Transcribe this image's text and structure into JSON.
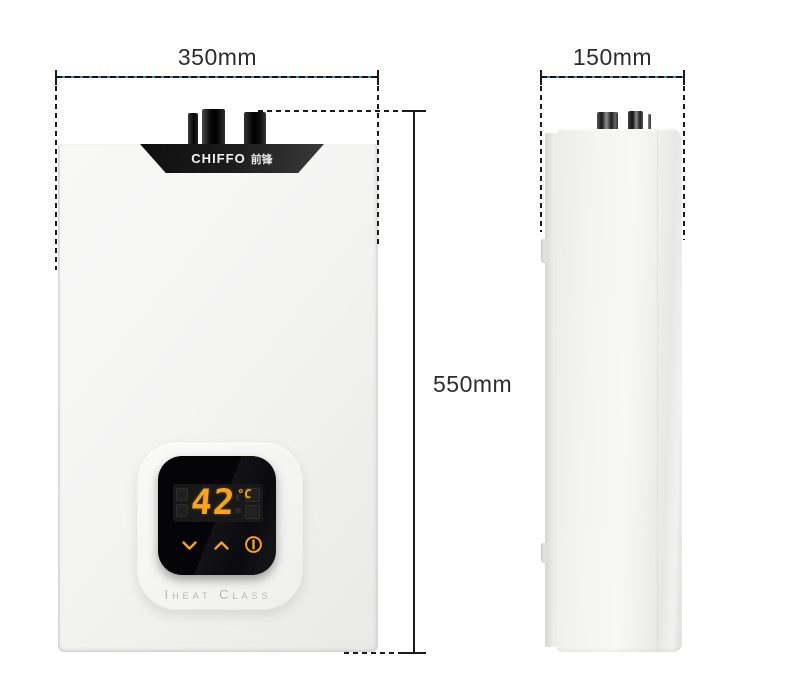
{
  "annotations": {
    "front_width_label": "350mm",
    "side_depth_label": "150mm",
    "height_label": "550mm"
  },
  "front_unit": {
    "brand_latin": "CHIFFO",
    "brand_cjk": "前锋",
    "display": {
      "temperature": "42",
      "temperature_unit": "°C",
      "button_icons": [
        "chevron-down-icon",
        "chevron-up-icon",
        "power-icon"
      ]
    },
    "series_label": "Iheat Class"
  },
  "colors": {
    "display_accent": "#f8a41b",
    "dimension_line": "#1b1b1b",
    "body_white": "#f3f3f2",
    "screen_black": "#0a0a0c",
    "brand_band_black": "#1c1c1c"
  }
}
